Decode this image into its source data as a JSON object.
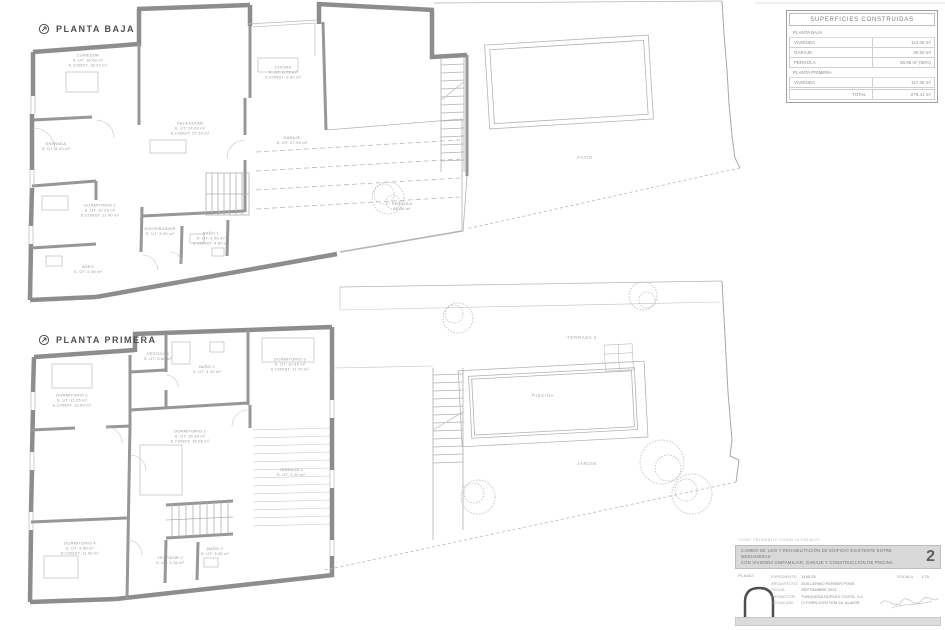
{
  "plans": [
    {
      "id": "planta-baja",
      "label": "PLANTA BAJA",
      "rooms": [
        {
          "x": 88,
          "y": 60,
          "lines": [
            "COMEDOR",
            "S. ÚT: 16.40 m²",
            "S.CONST: 18.20 m²"
          ]
        },
        {
          "x": 283,
          "y": 72,
          "lines": [
            "COCINA",
            "S. ÚT: 8.75 m²",
            "S.CONST: 9.90 m²"
          ]
        },
        {
          "x": 190,
          "y": 128,
          "lines": [
            "SALA ESTAR",
            "S. ÚT: 24.60 m²",
            "S.CONST: 27.10 m²"
          ]
        },
        {
          "x": 292,
          "y": 140,
          "lines": [
            "GARAJE",
            "S. ÚT: 27.90 m²"
          ]
        },
        {
          "x": 56,
          "y": 146,
          "lines": [
            "ENTRADA",
            "S. ÚT: 4.20 m²"
          ]
        },
        {
          "x": 100,
          "y": 210,
          "lines": [
            "DORMITORIO 1",
            "S. ÚT: 10.25 m²",
            "S.CONST: 11.40 m²"
          ]
        },
        {
          "x": 160,
          "y": 231,
          "lines": [
            "DISTRIBUIDOR",
            "S. ÚT: 3.40 m²"
          ]
        },
        {
          "x": 211,
          "y": 238,
          "lines": [
            "BAÑO 1",
            "S. ÚT: 4.05 m²",
            "S.CONST: 4.60 m²"
          ]
        },
        {
          "x": 88,
          "y": 269,
          "lines": [
            "ASEO",
            "S. ÚT: 2.45 m²"
          ]
        },
        {
          "x": 402,
          "y": 206,
          "lines": [
            "PÉRGOLA",
            "36.96 m²"
          ]
        },
        {
          "x": 585,
          "y": 158,
          "lines": [
            "PATIO"
          ],
          "outdoor": true
        }
      ]
    },
    {
      "id": "planta-primera",
      "label": "PLANTA PRIMERA",
      "rooms": [
        {
          "x": 72,
          "y": 400,
          "lines": [
            "DORMITORIO 2",
            "S. ÚT: 11.25 m²",
            "S.CONST: 12.60 m²"
          ]
        },
        {
          "x": 158,
          "y": 356,
          "lines": [
            "VESTIDOR",
            "S. ÚT: 3.60 m²"
          ]
        },
        {
          "x": 207,
          "y": 369,
          "lines": [
            "BAÑO 2",
            "S. ÚT: 4.10 m²"
          ]
        },
        {
          "x": 290,
          "y": 364,
          "lines": [
            "DORMITORIO 3",
            "S. ÚT: 10.45 m²",
            "S.CONST: 11.70 m²"
          ]
        },
        {
          "x": 190,
          "y": 436,
          "lines": [
            "DORMITORIO 1",
            "S. ÚT: 16.30 m²",
            "S.CONST: 18.05 m²"
          ]
        },
        {
          "x": 80,
          "y": 548,
          "lines": [
            "DORMITORIO 4",
            "S. ÚT: 9.85 m²",
            "S.CONST: 11.00 m²"
          ]
        },
        {
          "x": 170,
          "y": 560,
          "lines": [
            "VESTIDOR 2",
            "S. ÚT: 3.15 m²"
          ]
        },
        {
          "x": 215,
          "y": 551,
          "lines": [
            "BAÑO 3",
            "S. ÚT: 3.95 m²"
          ]
        },
        {
          "x": 291,
          "y": 472,
          "lines": [
            "TERRAZA 1",
            "S. ÚT: 9.20 m²"
          ]
        },
        {
          "x": 582,
          "y": 338,
          "lines": [
            "TERRAZA 2"
          ],
          "outdoor": true
        },
        {
          "x": 543,
          "y": 396,
          "lines": [
            "PISCINA"
          ],
          "outdoor": true
        },
        {
          "x": 587,
          "y": 464,
          "lines": [
            "JARDÍN"
          ],
          "outdoor": true
        }
      ]
    }
  ],
  "surface_table": {
    "title": "SUPERFICIES CONSTRUIDAS",
    "rows": [
      {
        "type": "section",
        "label": "PLANTA BAJA",
        "value": ""
      },
      {
        "type": "item",
        "label": "VIVIENDA",
        "value": "113.05 m²"
      },
      {
        "type": "item",
        "label": "GARAJE",
        "value": "30.50 m²"
      },
      {
        "type": "item",
        "label": "PÉRGOLA",
        "value": "36.96 m² (50%)"
      },
      {
        "type": "section",
        "label": "PLANTA PRIMERA",
        "value": ""
      },
      {
        "type": "item",
        "label": "VIVIENDA",
        "value": "117.38 m²"
      },
      {
        "type": "total",
        "label": "TOTAL",
        "value": "279.41 m²"
      }
    ]
  },
  "titleblock": {
    "stamp_line": "VISAT TELEMÀTIC COAIB 12/09345/21",
    "project_title_line1": "CAMBIO DE USO Y REHABILITACIÓN DE EDIFICIO EXISTENTE ENTRE MEDIANERAS",
    "project_title_line2": "CON VIVIENDA UNIFAMILIAR, GARAJE Y CONSTRUCCIÓN DE PISCINA",
    "sheet_number": "2",
    "plano_label": "PLANO:",
    "fields": [
      {
        "label": "EXPEDIENTE:",
        "value": "1446-05"
      },
      {
        "label": "ARQUITECTO:",
        "value": "GUILLERMO FERRER PONS"
      },
      {
        "label": "FECHA:",
        "value": "SEPTIEMBRE 2021"
      },
      {
        "label": "PROMOTOR:",
        "value": "TURQUESA DUPLEX COSTA, S.L."
      },
      {
        "label": "SITUACIÓN:",
        "value": "C/ FORN D'EN TEM 24. ALAIOR"
      }
    ],
    "escala_label": "ESCALA",
    "escala_value": "1:75"
  },
  "colors": {
    "wall": "#8d8d8d",
    "thin_line": "#b3b3b3",
    "label_text": "#9a9a9a",
    "titlebar_bg": "#d9d9d9"
  }
}
